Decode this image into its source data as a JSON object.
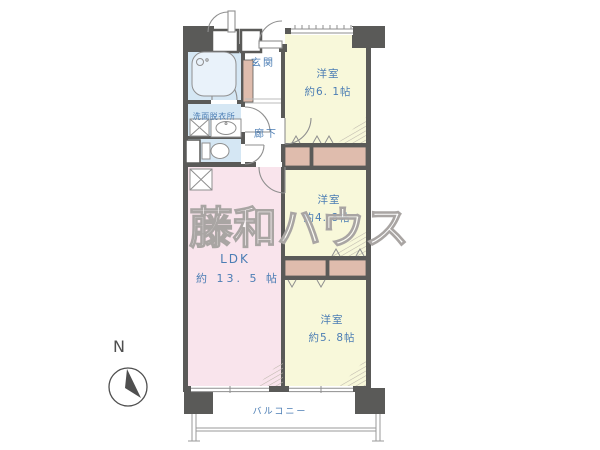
{
  "labels": {
    "watermark": "藤和ハウス",
    "compass": "N",
    "entrance": "玄関",
    "washroom": "洗面脱衣所",
    "hallway": "廊下",
    "room1_name": "洋室",
    "room1_size": "約6. 1帖",
    "room2_name": "洋室",
    "room2_size": "約4. 8帖",
    "room3_name": "洋室",
    "room3_size": "約5. 8帖",
    "ldk_name": "LDK",
    "ldk_size": "約 13. 5 帖",
    "balcony": "バルコニー"
  },
  "colors": {
    "wall": "#5a5a58",
    "room_yellow": "#f8f8da",
    "ldk_pink": "#f9e4ec",
    "wet_blue": "#d5e7f4",
    "closet_brown": "#dfbcad",
    "label_blue": "#4b7db4",
    "line_gray": "#8f8f8f",
    "balcony_gray": "#9a9a9a",
    "watermark_stroke": "#a9a5a3",
    "compass_dark": "#4f4f4f"
  }
}
